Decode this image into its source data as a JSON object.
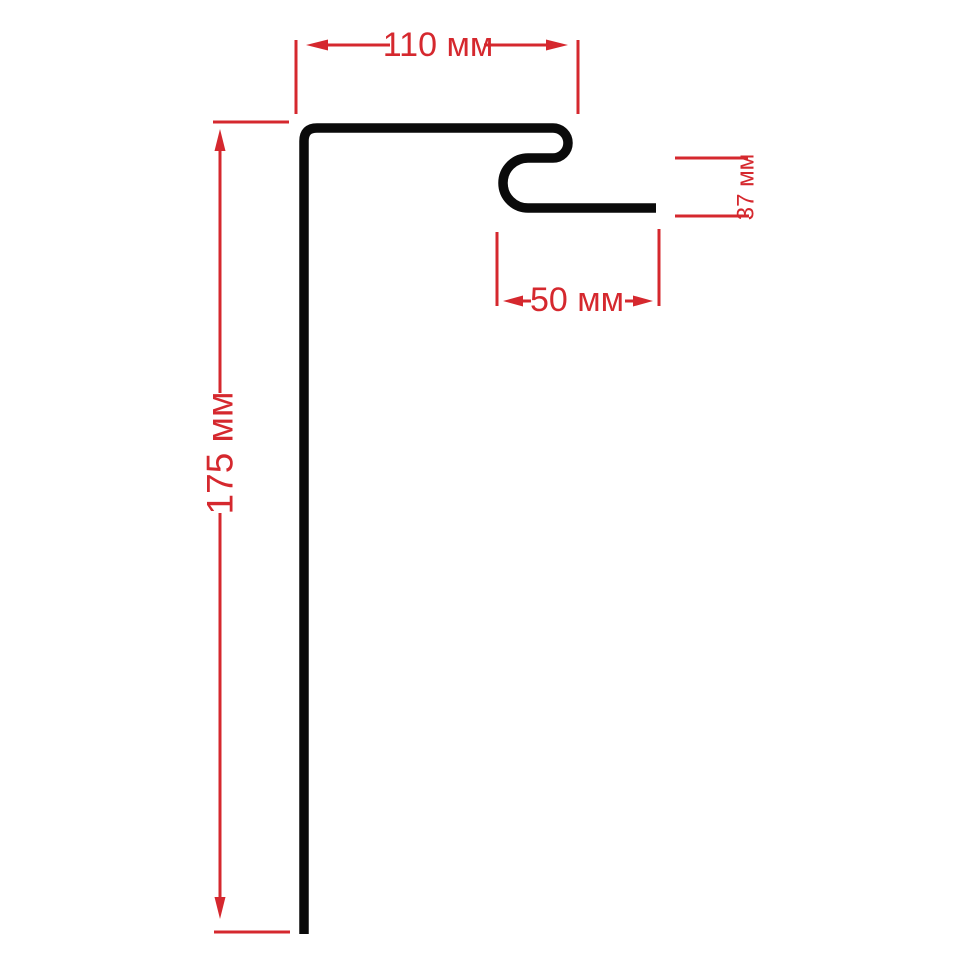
{
  "diagram": {
    "kind": "profile-dimension-drawing",
    "unit_suffix": "мм",
    "dimensions": {
      "top_width": {
        "label": "110 мм",
        "value": 110
      },
      "side_height": {
        "label": "175 мм",
        "value": 175
      },
      "hook_width": {
        "label": "50 мм",
        "value": 50
      },
      "hook_height": {
        "label": "37 мм",
        "value": 37
      }
    },
    "colors": {
      "profile": "#0a0a0a",
      "dimension": "#d5282e",
      "background": "#ffffff"
    }
  }
}
